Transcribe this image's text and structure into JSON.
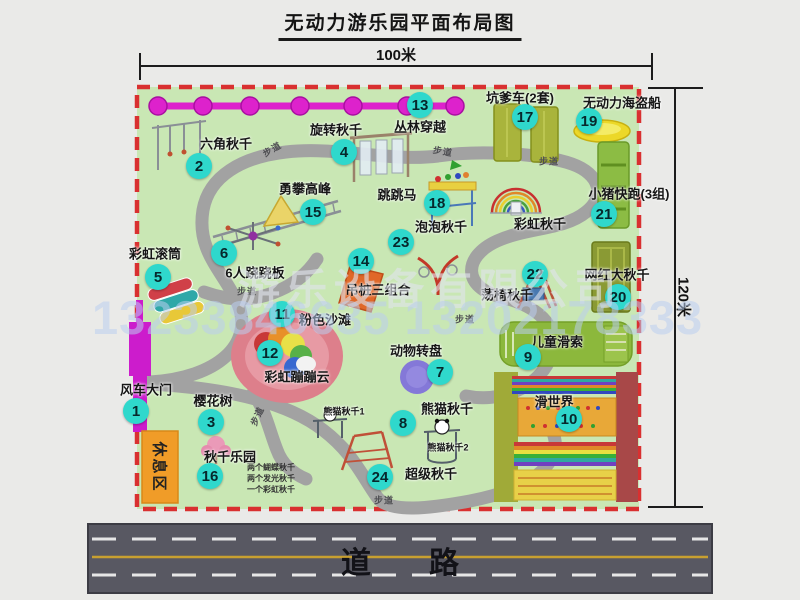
{
  "title": "无动力游乐园平面布局图",
  "dimensions": {
    "width_label": "100米",
    "height_label": "120米"
  },
  "road": {
    "label": "道路"
  },
  "watermark": {
    "company": "游乐设备有限公司",
    "phone": "13233846635 13202178333"
  },
  "colors": {
    "badge": "#2fd8cc",
    "park_green": "#c9e7b4",
    "border_red": "#d93030",
    "gate_magenta": "#cc1ccc",
    "rest_orange": "#f09c28",
    "road_gray": "#585862"
  },
  "rest_area_label": "休息区",
  "attractions": [
    {
      "id": 1,
      "name": "风车大门",
      "bx": 136,
      "by": 411,
      "lx": 146,
      "ly": 389
    },
    {
      "id": 2,
      "name": "六角秋千",
      "bx": 199,
      "by": 166,
      "lx": 226,
      "ly": 143
    },
    {
      "id": 3,
      "name": "樱花树",
      "bx": 211,
      "by": 422,
      "lx": 213,
      "ly": 400
    },
    {
      "id": 4,
      "name": "旋转秋千",
      "bx": 344,
      "by": 152,
      "lx": 336,
      "ly": 129
    },
    {
      "id": 5,
      "name": "彩虹滚筒",
      "bx": 158,
      "by": 277,
      "lx": 155,
      "ly": 253
    },
    {
      "id": 6,
      "name": "6人跷跷板",
      "bx": 224,
      "by": 253,
      "lx": 255,
      "ly": 272
    },
    {
      "id": 7,
      "name": "动物转盘",
      "bx": 440,
      "by": 372,
      "lx": 416,
      "ly": 350
    },
    {
      "id": 8,
      "name": "熊猫秋千",
      "bx": 403,
      "by": 423,
      "lx": 447,
      "ly": 408
    },
    {
      "id": 9,
      "name": "儿童滑索",
      "bx": 528,
      "by": 357,
      "lx": 557,
      "ly": 341
    },
    {
      "id": 10,
      "name": "滑世界",
      "bx": 569,
      "by": 419,
      "lx": 554,
      "ly": 401
    },
    {
      "id": 11,
      "name": "粉色沙滩",
      "bx": 282,
      "by": 314,
      "lx": 325,
      "ly": 319
    },
    {
      "id": 12,
      "name": "彩虹蹦蹦云",
      "bx": 270,
      "by": 353,
      "lx": 297,
      "ly": 376
    },
    {
      "id": 13,
      "name": "丛林穿越",
      "bx": 420,
      "by": 105,
      "lx": 420,
      "ly": 126
    },
    {
      "id": 14,
      "name": "吊桩三组合",
      "bx": 361,
      "by": 261,
      "lx": 378,
      "ly": 289
    },
    {
      "id": 15,
      "name": "勇攀高峰",
      "bx": 313,
      "by": 212,
      "lx": 305,
      "ly": 188
    },
    {
      "id": 16,
      "name": "秋千乐园",
      "bx": 210,
      "by": 476,
      "lx": 230,
      "ly": 456
    },
    {
      "id": 17,
      "name": "坑爹车(2套)",
      "bx": 525,
      "by": 117,
      "lx": 520,
      "ly": 97
    },
    {
      "id": 18,
      "name": "跳跳马",
      "bx": 437,
      "by": 203,
      "lx": 397,
      "ly": 194
    },
    {
      "id": 19,
      "name": "无动力海盗船",
      "bx": 589,
      "by": 121,
      "lx": 622,
      "ly": 102
    },
    {
      "id": 20,
      "name": "网红大秋千",
      "bx": 618,
      "by": 297,
      "lx": 617,
      "ly": 274
    },
    {
      "id": 21,
      "name": "小猪快跑(3组)",
      "bx": 604,
      "by": 214,
      "lx": 629,
      "ly": 193
    },
    {
      "id": 22,
      "name": "荡椅秋千",
      "bx": 535,
      "by": 274,
      "lx": 507,
      "ly": 294
    },
    {
      "id": 23,
      "name": "泡泡秋千",
      "bx": 401,
      "by": 242,
      "lx": 441,
      "ly": 226
    },
    {
      "id": 24,
      "name": "超级秋千",
      "bx": 380,
      "by": 477,
      "lx": 431,
      "ly": 473
    }
  ],
  "extra_labels": [
    {
      "key": "rainbow-swing-label",
      "text": "彩虹秋千",
      "x": 540,
      "y": 223,
      "size": 13
    },
    {
      "key": "panda-swing-1-label",
      "text": "熊猫秋千1",
      "x": 344,
      "y": 411,
      "size": 9
    },
    {
      "key": "panda-swing-2-label",
      "text": "熊猫秋千2",
      "x": 448,
      "y": 447,
      "size": 9
    }
  ],
  "swing_park_items": [
    "两个蝴蝶秋千",
    "两个发光秋千",
    "一个彩虹秋千"
  ],
  "walkway_labels": [
    {
      "text": "步道",
      "x": 272,
      "y": 149,
      "rot": -30
    },
    {
      "text": "步道",
      "x": 443,
      "y": 151,
      "rot": 10
    },
    {
      "text": "步道",
      "x": 549,
      "y": 161,
      "rot": 0
    },
    {
      "text": "步道",
      "x": 247,
      "y": 291,
      "rot": 0
    },
    {
      "text": "步道",
      "x": 465,
      "y": 319,
      "rot": 0
    },
    {
      "text": "步道",
      "x": 257,
      "y": 416,
      "rot": -65
    },
    {
      "text": "步道",
      "x": 384,
      "y": 500,
      "rot": 0
    }
  ]
}
